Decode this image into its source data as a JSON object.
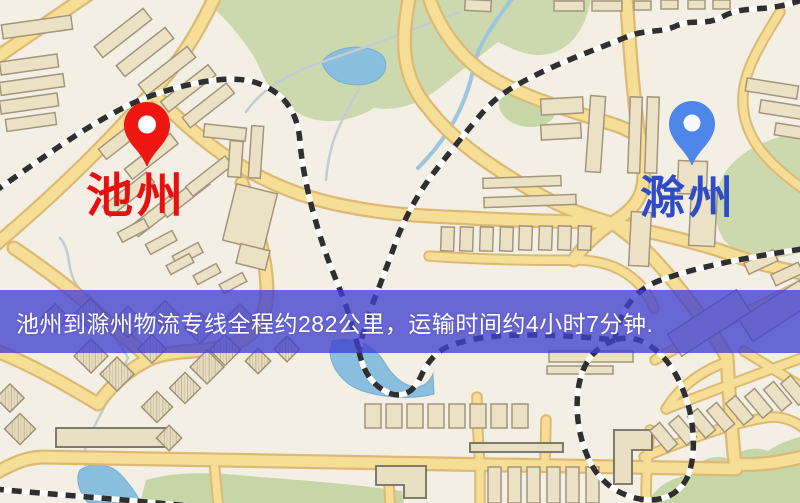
{
  "banner": {
    "text": "池州到滁州物流专线全程约282公里，运输时间约4小时7分钟.",
    "background_color": "#4040ce",
    "text_color": "#ffffff"
  },
  "origin": {
    "name": "池州",
    "label_color": "#e80f0f",
    "pin_color": "#ed1610",
    "pin_icon": "map-pin-icon"
  },
  "destination": {
    "name": "滁州",
    "label_color": "#2e4bc8",
    "pin_color": "#4e86ea",
    "pin_icon": "map-pin-icon"
  },
  "map_palette": {
    "background": "#f3efe4",
    "road_fill": "#f7de96",
    "road_casing": "#dcba74",
    "park_green": "#ccd9ae",
    "water_blue": "#8abede",
    "railway_dark": "#2f2f2f",
    "building_fill": "#ebe1c5",
    "building_stroke": "#a4957c"
  }
}
